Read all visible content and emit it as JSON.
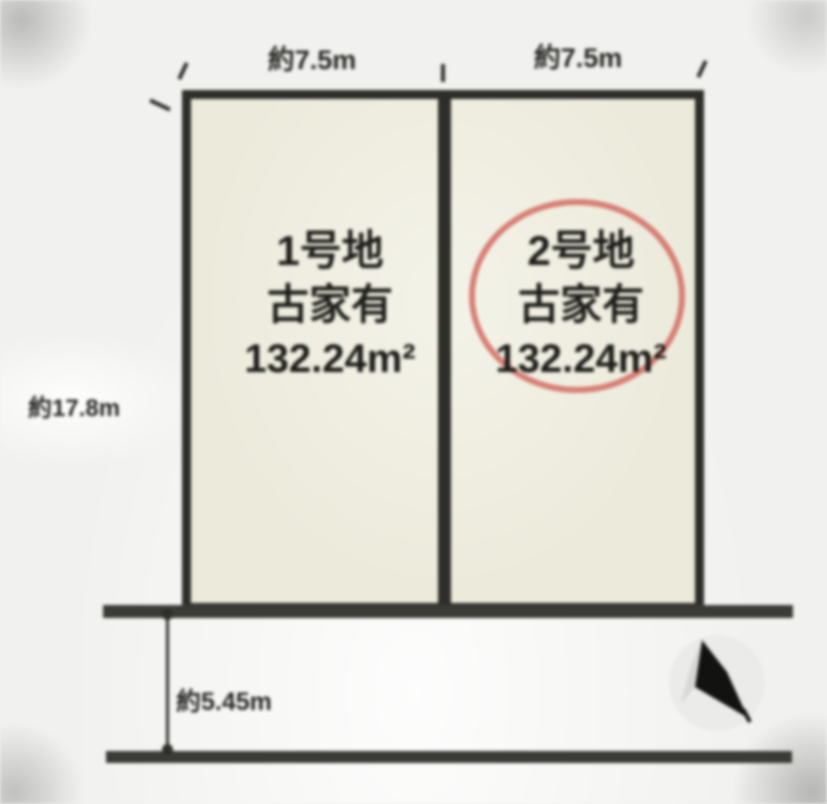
{
  "diagram": {
    "type": "land-plot-layout",
    "lots": [
      {
        "name": "1号地",
        "building_note": "古家有",
        "area": "132.24m²",
        "frontage_label": "約7.5m",
        "highlighted": false
      },
      {
        "name": "2号地",
        "building_note": "古家有",
        "area": "132.24m²",
        "frontage_label": "約7.5m",
        "highlighted": true
      }
    ],
    "depth_label": "約17.8m",
    "road_width_label": "約5.45m",
    "compass": "north-arrow",
    "colors": {
      "background": "#f1f1ef",
      "lot_fill": "#eceadb",
      "outline": "#2d2d29",
      "road_line": "#3a3a36",
      "highlight_ellipse": "#d26b61",
      "text": "#1c1c19"
    }
  }
}
